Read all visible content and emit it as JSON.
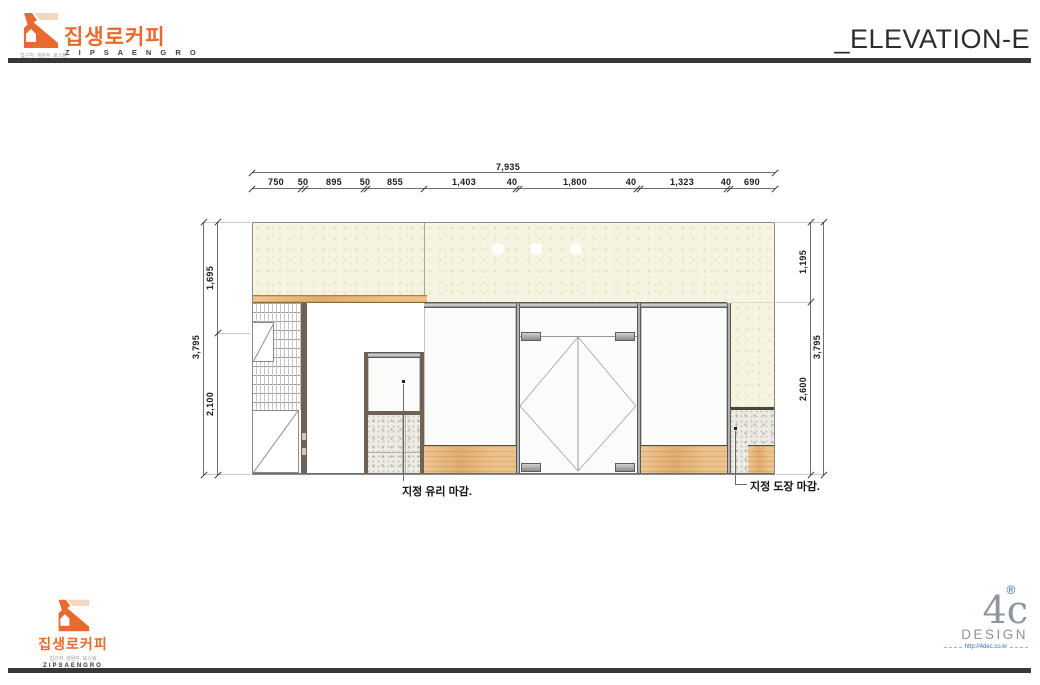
{
  "header": {
    "logo": {
      "korean": "집생로커피",
      "romanized": "Z I P S A E N G R O",
      "tagline": "집근처. 생원두. 로스팅"
    },
    "title": "_ELEVATION-E"
  },
  "dimensions": {
    "top": {
      "overall": "7,935",
      "segments": [
        "750",
        "50",
        "895",
        "50",
        "855",
        "1,403",
        "40",
        "1,800",
        "40",
        "1,323",
        "40",
        "690"
      ]
    },
    "left": {
      "upper": "1,695",
      "overall": "3,795",
      "lower": "2,100"
    },
    "right": {
      "upper": "1,195",
      "overall": "3,795",
      "lower": "2,600"
    }
  },
  "annotations": {
    "glass": "지정 유리 마감.",
    "paint": "지정 도장 마감."
  },
  "footer": {
    "logo": {
      "korean": "집생로커피",
      "romanized": "ZIPSAENGRO",
      "tagline": "집근처. 생원두. 로스팅"
    },
    "designer": {
      "name": "4c",
      "reg": "®",
      "sub": "DESIGN",
      "url": "http://4dec.co.kr"
    }
  },
  "colors": {
    "brand_orange": "#e96a2e",
    "brand_beige": "#f3d8bf",
    "ceiling_cream": "#f8f4e2",
    "wood": "#e9b678",
    "frame_gray": "#8f8f8f",
    "reg_blue": "#2f6db0"
  }
}
